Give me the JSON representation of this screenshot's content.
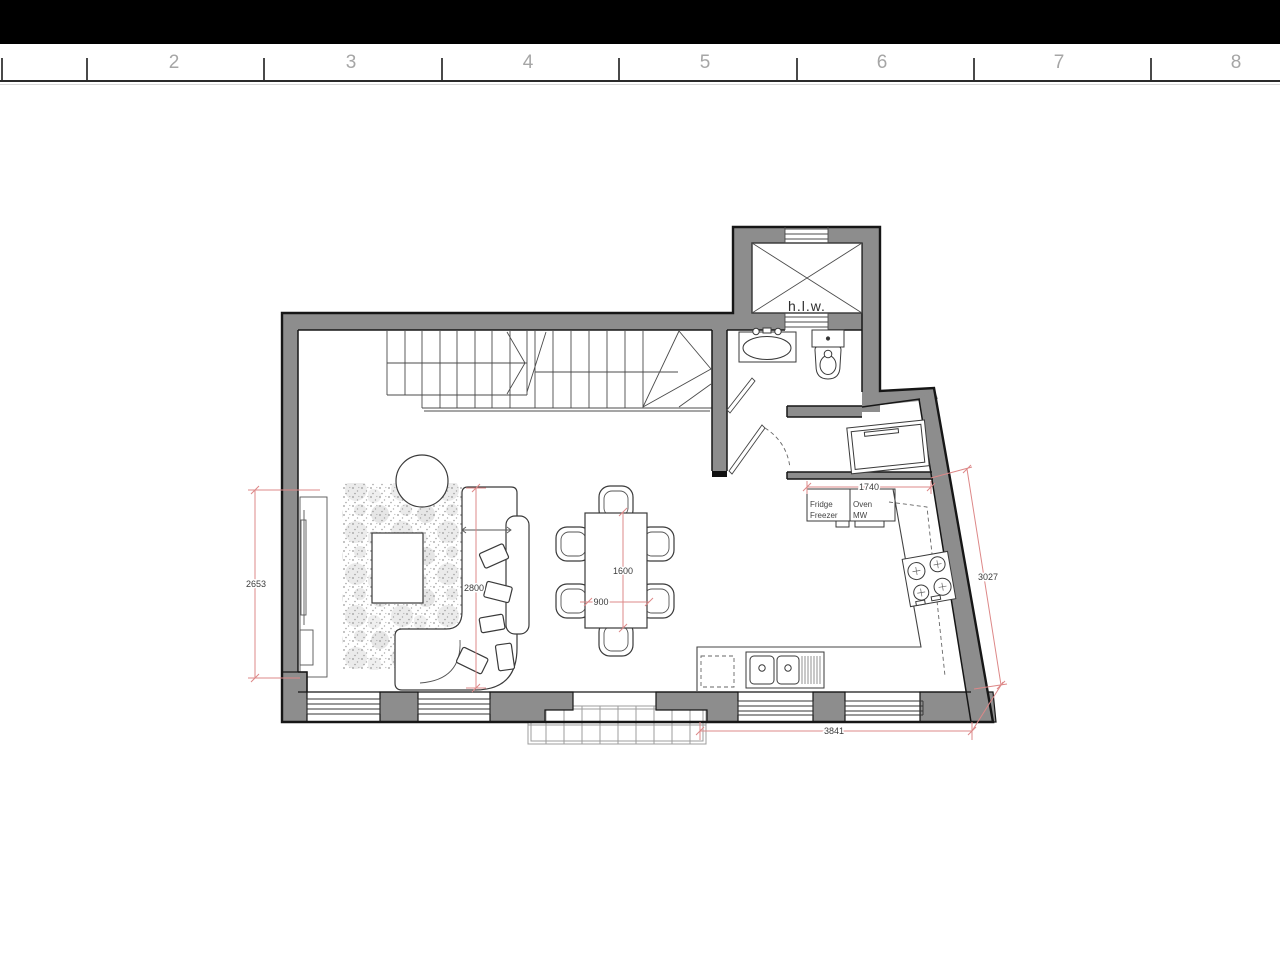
{
  "ruler": {
    "numbers": [
      "2",
      "3",
      "4",
      "5",
      "6",
      "7",
      "8"
    ]
  },
  "plan": {
    "lift_label": "h.l.w.",
    "kitchen_labels": {
      "fridge_l1": "Fridge",
      "fridge_l2": "Freezer",
      "oven_l1": "Oven",
      "oven_l2": "MW"
    },
    "dimensions": {
      "living_depth": "2653",
      "living_width": "2800",
      "table_length": "1600",
      "table_width": "900",
      "units_run": "1740",
      "kitchen_side": "3027",
      "kitchen_run": "3841"
    },
    "colors": {
      "wall": "#8d8d8d",
      "outline": "#161616",
      "line": "#4b4b4b",
      "dim_line": "#dd8888",
      "dim_text": "#3c3c3c",
      "ruler_number": "#a6a6a6"
    }
  }
}
